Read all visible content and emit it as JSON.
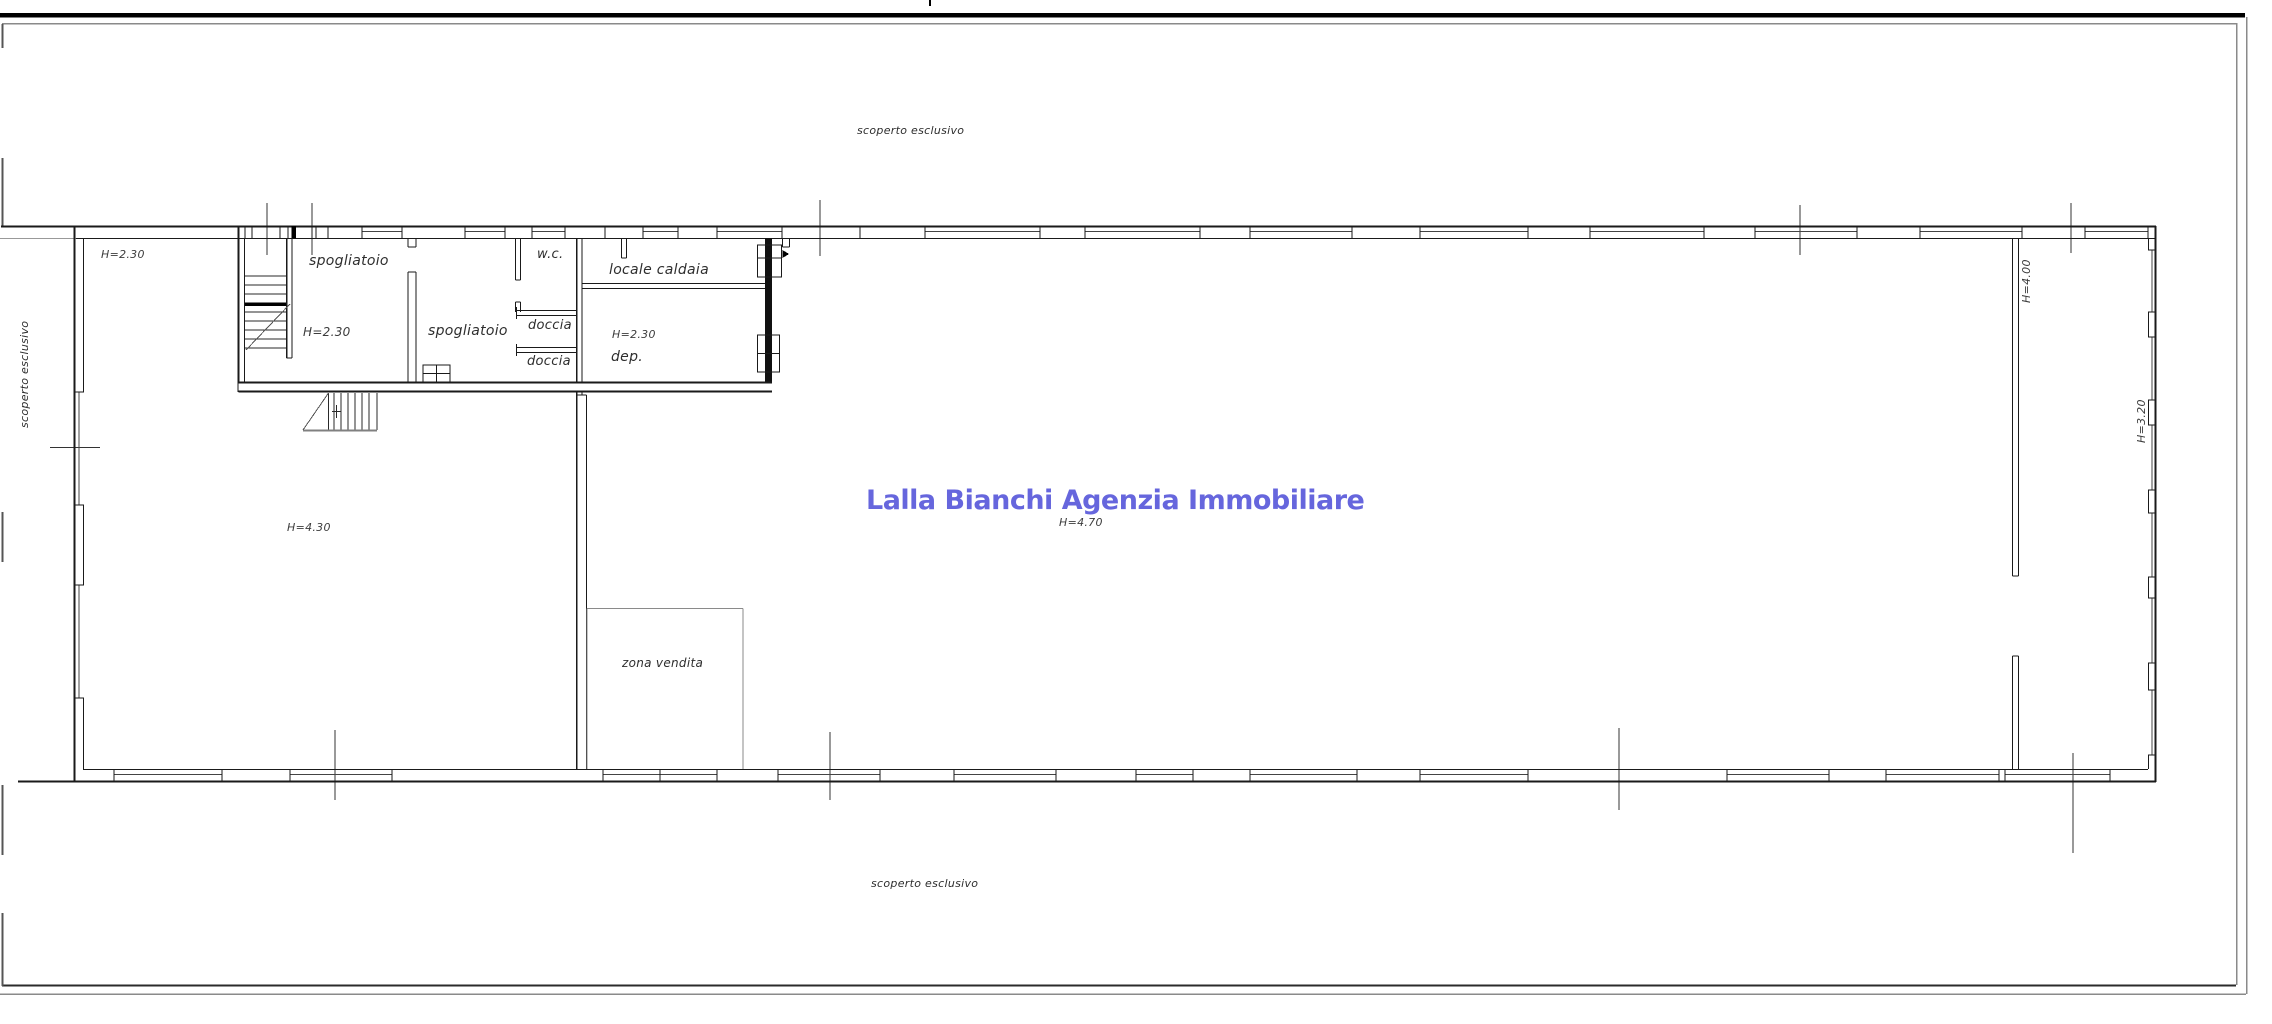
{
  "watermark": {
    "text": "Lalla Bianchi Agenzia Immobiliare",
    "color": "#6666dd"
  },
  "areas": {
    "outdoor_top": {
      "label": "scoperto esclusivo"
    },
    "outdoor_bottom": {
      "label": "scoperto esclusivo"
    },
    "outdoor_left": {
      "label": "scoperto esclusivo"
    },
    "entry_left": {
      "height": "H=2.30"
    },
    "stair_room": {
      "label": "spogliatoio",
      "height": "H=2.30"
    },
    "changing_room": {
      "label": "spogliatoio"
    },
    "wc": {
      "label": "w.c."
    },
    "shower_1": {
      "label": "doccia"
    },
    "shower_2": {
      "label": "doccia"
    },
    "boiler_room": {
      "label": "locale caldaia"
    },
    "storage": {
      "label": "dep.",
      "height": "H=2.30"
    },
    "hall_left": {
      "height": "H=4.30"
    },
    "main_hall": {
      "height": "H=4.70"
    },
    "sales_area": {
      "label": "zona vendita"
    },
    "right_aisle": {
      "height": "H=4.00"
    },
    "right_wall": {
      "height": "H=3.20"
    }
  }
}
